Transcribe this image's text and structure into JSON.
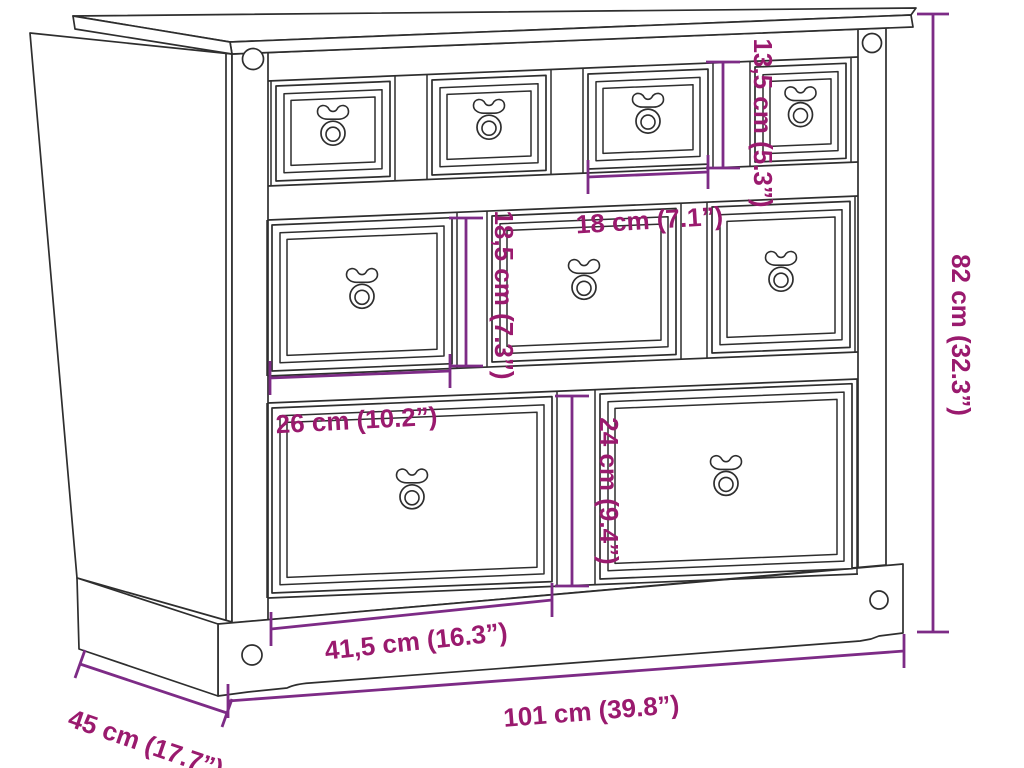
{
  "diagram": {
    "dimensions": {
      "drawer_small_height": "13,5 cm (5.3”)",
      "drawer_small_width": "18 cm (7.1”)",
      "drawer_mid_height": "18,5 cm (7.3”)",
      "drawer_mid_width": "26 cm (10.2”)",
      "drawer_large_height": "24 cm (9.4”)",
      "drawer_large_width": "41,5 cm (16.3”)",
      "total_width": "101 cm (39.8”)",
      "total_depth": "45 cm (17.7”)",
      "total_height": "82 cm (32.3”)"
    },
    "colors": {
      "dimension_text": "#9a1a6e",
      "dimension_line": "#7d2b86",
      "line_art": "#2e2e2e",
      "background": "#ffffff"
    }
  }
}
